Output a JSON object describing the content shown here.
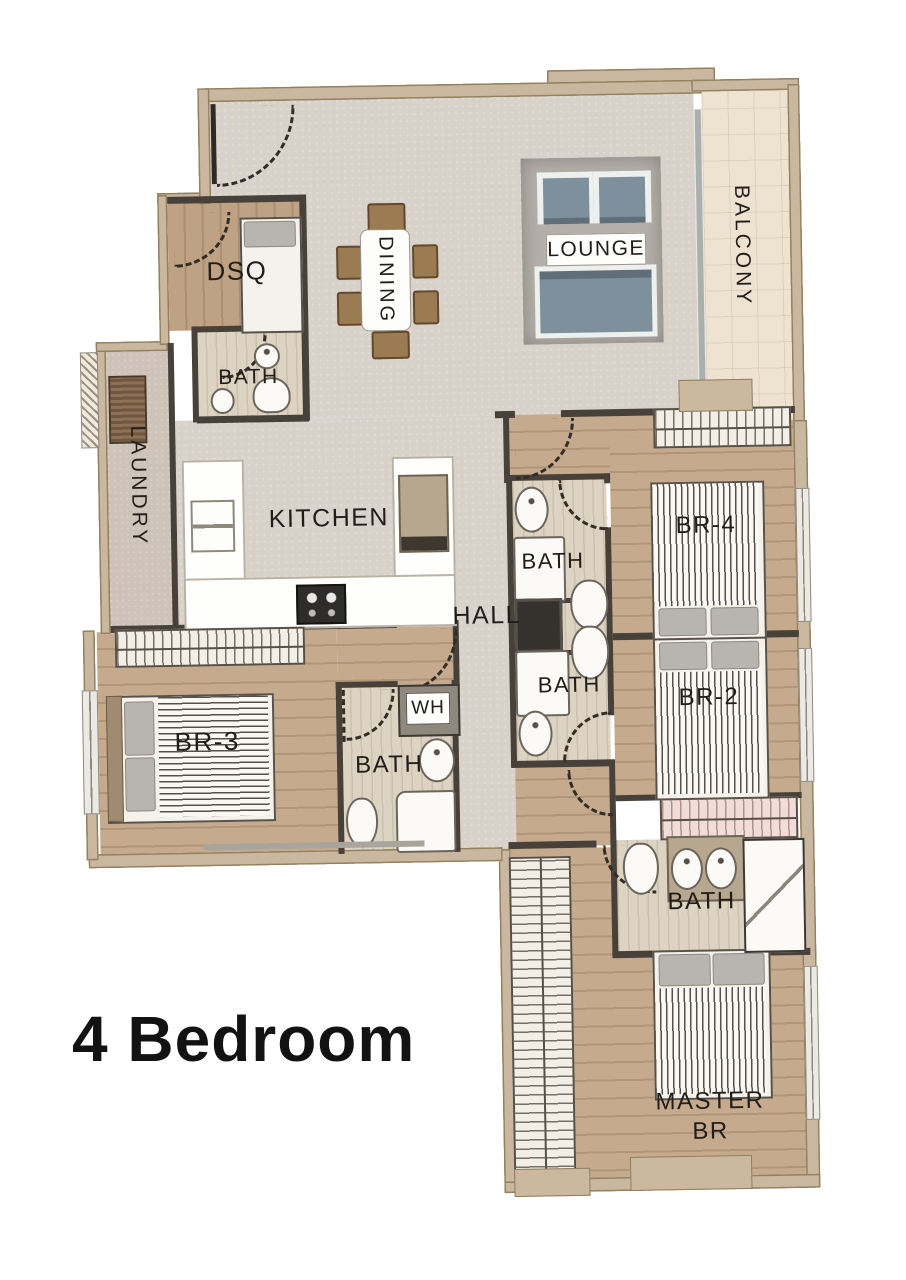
{
  "title": {
    "text": "4 Bedroom"
  },
  "rooms": {
    "dsq": {
      "label": "DSQ"
    },
    "dining": {
      "label": "DINING"
    },
    "lounge": {
      "label": "LOUNGE"
    },
    "balcony": {
      "label": "BALCONY"
    },
    "bath_dsq": {
      "label": "BATH"
    },
    "laundry": {
      "label": "LAUNDRY"
    },
    "kitchen": {
      "label": "KITCHEN"
    },
    "hall": {
      "label": "HALL"
    },
    "bath_upper": {
      "label": "BATH"
    },
    "br4": {
      "label": "BR-4"
    },
    "bath_lower": {
      "label": "BATH"
    },
    "br2": {
      "label": "BR-2"
    },
    "br3": {
      "label": "BR-3"
    },
    "water_heater": {
      "label": "WH"
    },
    "bath_br3": {
      "label": "BATH"
    },
    "bath_master": {
      "label": "BATH"
    },
    "master": {
      "label": "MASTER BR",
      "line1": "MASTER",
      "line2": "BR"
    }
  },
  "colors": {
    "background": "#ffffff",
    "wall_interior": "#47413a",
    "wall_exterior": "#c9b7a0",
    "floor_living": "#d9d2cb",
    "floor_wood": "#c6aa8d",
    "floor_bath": "#ddd3c2",
    "floor_balcony": "#eee2d1",
    "floor_laundry": "#cdc3b8",
    "rug": "#b4afa9",
    "sofa": "#7e909b",
    "chair_wood": "#9b7b52",
    "label_text": "#211d18"
  }
}
